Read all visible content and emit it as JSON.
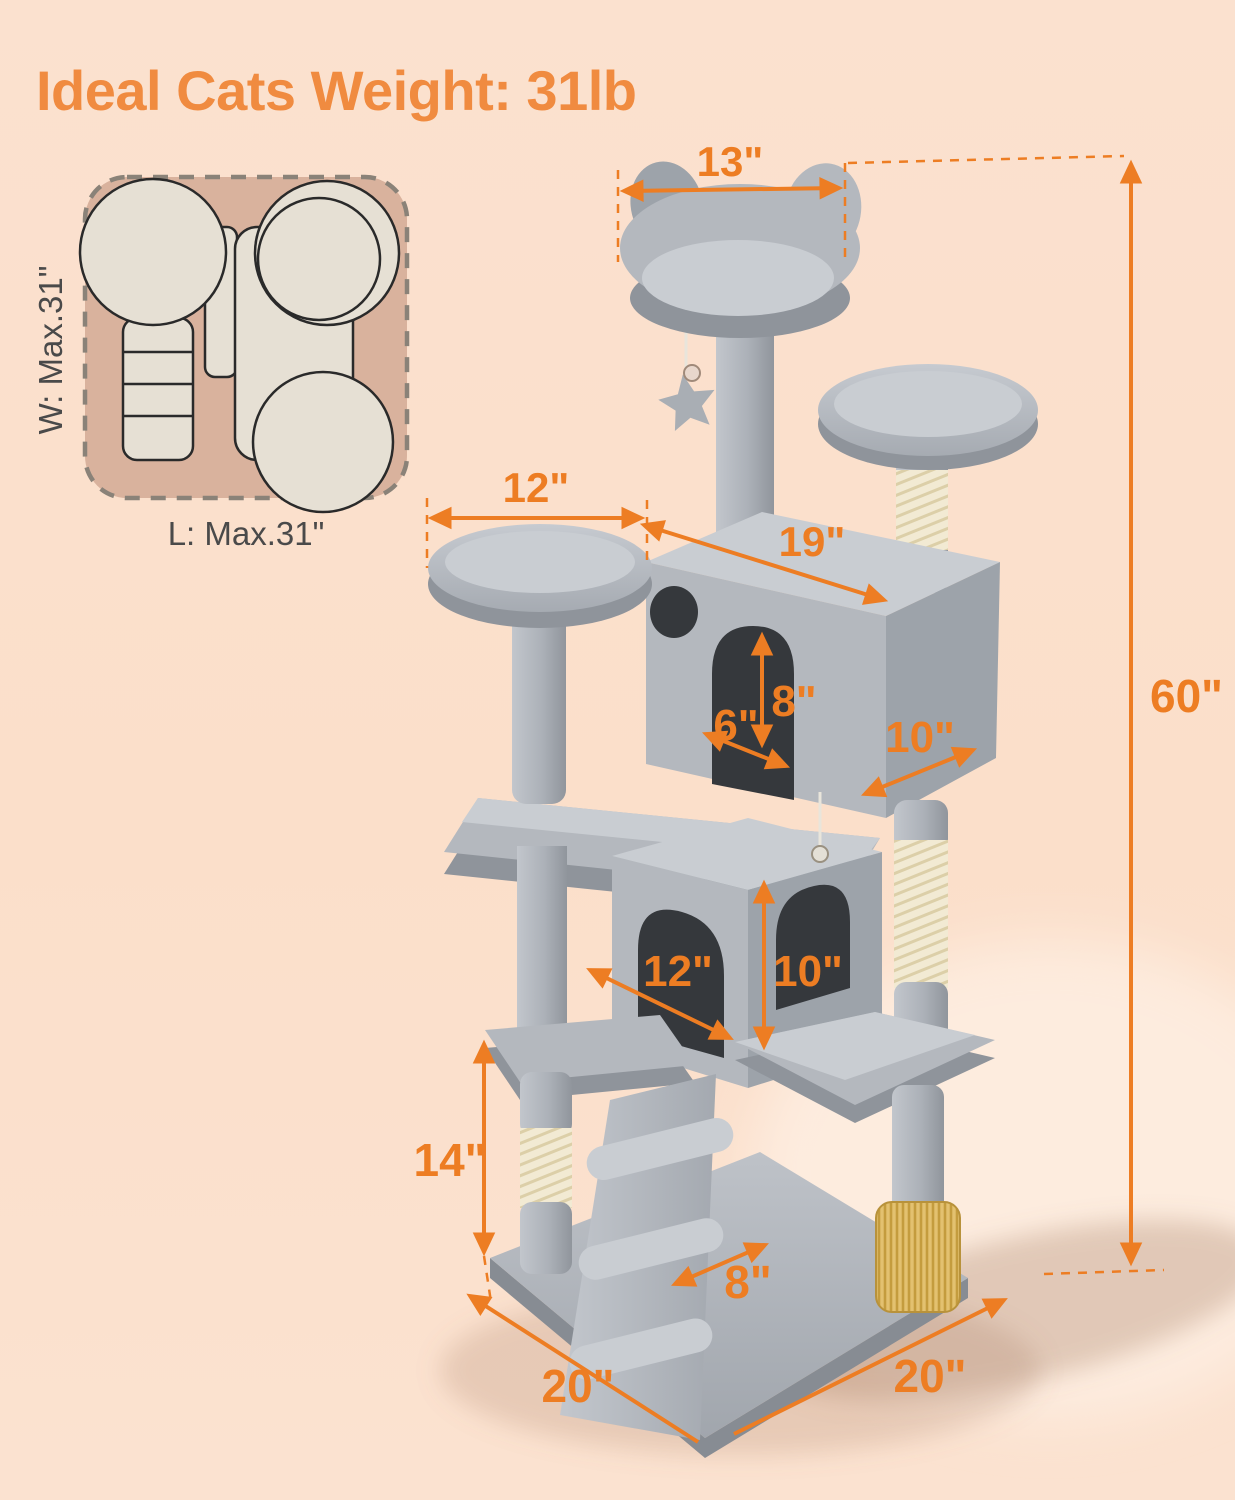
{
  "title": "Ideal Cats Weight: 31lb",
  "footprint": {
    "width_label": "W: Max.31\"",
    "length_label": "L: Max.31\""
  },
  "dimensions": {
    "top_perch_width": "13\"",
    "left_perch_width": "12\"",
    "upper_condo_length": "19\"",
    "upper_door_height": "8\"",
    "upper_ledge_depth": "6\"",
    "upper_condo_depth": "10\"",
    "lower_condo_width": "12\"",
    "lower_condo_height": "10\"",
    "lower_post_height": "14\"",
    "ramp_width": "8\"",
    "base_depth": "20\"",
    "base_width": "20\"",
    "total_height": "60\""
  },
  "colors": {
    "accent": "#ED7D23",
    "title_color": "#F08B40",
    "background": "#FBE0CC",
    "plush": "#B4B8BE",
    "plush_dark": "#9DA3AA",
    "plush_light": "#C9CDD2",
    "plush_deep": "#8F949B",
    "sisal": "#F2EAD3",
    "brush": "#E3C170",
    "interior": "#35383C",
    "inset_bg": "#D9B29D",
    "inset_shape": "#E6E0D4",
    "outline": "#2A2A2A",
    "label": "#4A4A4A"
  }
}
